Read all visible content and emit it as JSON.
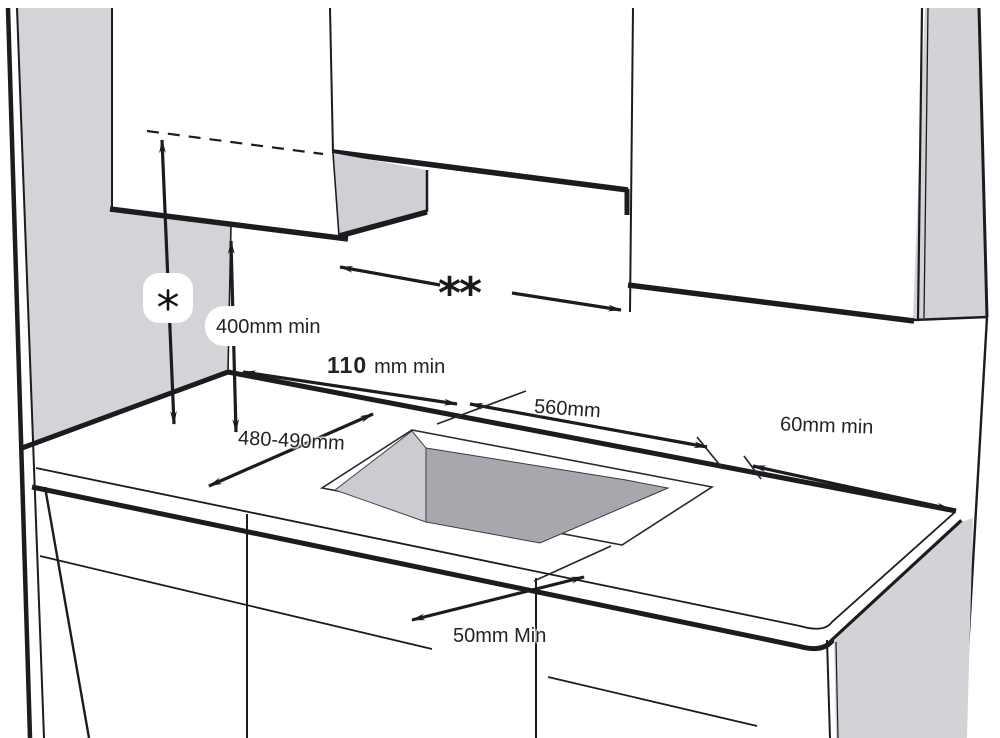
{
  "labels": {
    "star": "*",
    "double_star": "**",
    "height_min": "400mm min",
    "rear_clearance_value": "110",
    "rear_clearance_unit": "mm min",
    "cutout_width": "560mm",
    "cutout_depth": "480-490mm",
    "right_clearance": "60mm min",
    "front_clearance": "50mm Min"
  },
  "colors": {
    "wall_gray": "#d3d3d8",
    "hood_gray": "#cfcfd5",
    "panel_gray": "#d2d2d7",
    "cutout_side_gray": "#cbcbd1",
    "cutout_face_gray": "#a7a7ae",
    "line": "#1c1c20",
    "text": "#232327"
  }
}
